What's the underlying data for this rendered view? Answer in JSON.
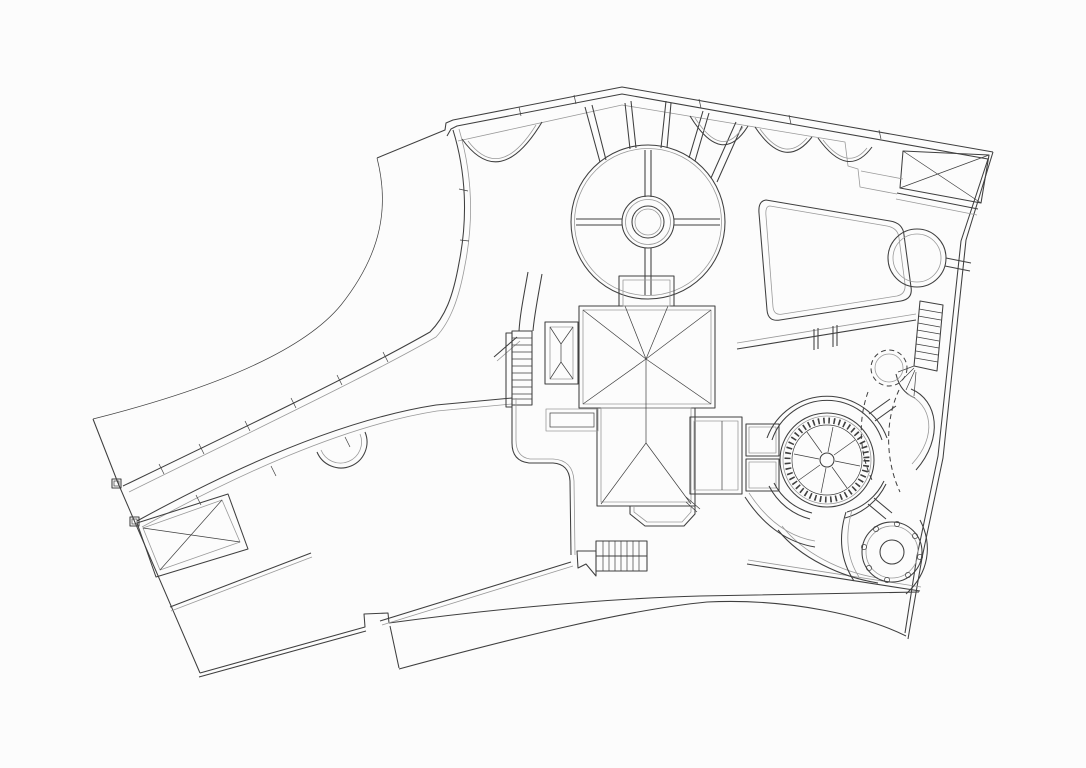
{
  "meta": {
    "title": "Residential estate site plan — roof and landscape line drawing",
    "drawing_type": "architectural plan, black line work on white, no text labels visible"
  },
  "canvas": {
    "width": 1086,
    "height": 768,
    "background": "#fcfcfc",
    "ink": "#3f3f3f",
    "soft": "#9a9a9a"
  },
  "features": [
    {
      "id": "site-boundary",
      "label": "Site boundary wall with pointed south-east corner"
    },
    {
      "id": "access-drive-wall",
      "label": "Long curved retaining walls of access drive with joint ticks and end posts"
    },
    {
      "id": "lawn-edge-curve",
      "label": "Sweeping lawn edge curve, north-west quadrant"
    },
    {
      "id": "parterre-garden",
      "label": "Circular parterre garden with concentric rings and cross paths"
    },
    {
      "id": "garden-bed-scallops",
      "label": "Scalloped planting-bed edges along north boundary"
    },
    {
      "id": "radial-paths",
      "label": "Radial paths linking parterre to north boundary"
    },
    {
      "id": "main-house-roof",
      "label": "Main house hipped roof with ridge and valley lines"
    },
    {
      "id": "entry-porch",
      "label": "North entry porch"
    },
    {
      "id": "bay-skylight",
      "label": "West bay with hipped skylight"
    },
    {
      "id": "side-stair",
      "label": "West side stair run"
    },
    {
      "id": "rear-stair",
      "label": "South stair below house"
    },
    {
      "id": "east-terrace",
      "label": "East terrace deck"
    },
    {
      "id": "pergola-bridge",
      "label": "Twin pergola links from terrace to fountain"
    },
    {
      "id": "fountain",
      "label": "Circular fountain with dentil coping, radial jets and broken ring walk"
    },
    {
      "id": "spa-pool",
      "label": "Round spa / turret roof with bolt ring"
    },
    {
      "id": "lawn-panel",
      "label": "Rounded lawn panel, east garden"
    },
    {
      "id": "ne-trellis",
      "label": "North-east cross-braced trellis canopy"
    },
    {
      "id": "west-trellis",
      "label": "West cross-braced carport trellis"
    },
    {
      "id": "tree-ring",
      "label": "Round tree ring, north-east"
    },
    {
      "id": "garden-stair",
      "label": "East boundary stair with fan steps"
    },
    {
      "id": "drip-lines",
      "label": "Dashed planting drip lines, east garden"
    },
    {
      "id": "south-walk",
      "label": "Curved south walks and bottom boundary band"
    }
  ]
}
